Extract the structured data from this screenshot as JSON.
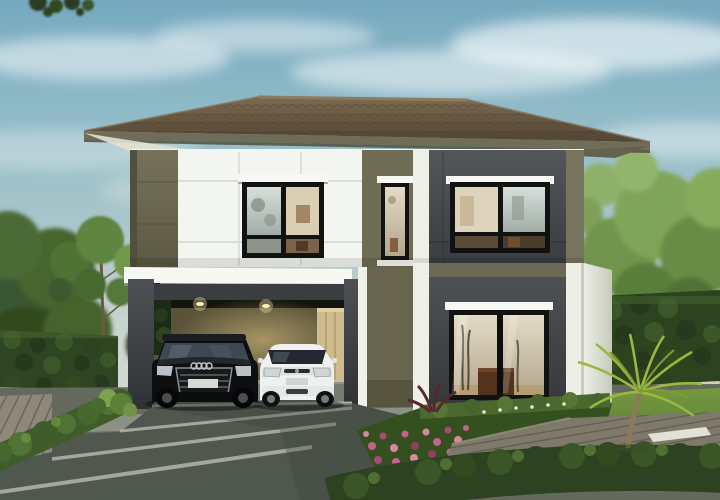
{
  "scene": {
    "type": "architectural-rendering",
    "description": "Daytime exterior rendering of a modern two-storey detached house with hipped brown tile roof, olive and white panelled upper facade, charcoal lower wing, an open carport containing a black SUV and a white hatchback, paver driveway, timber decks, trimmed hedges, pink flower beds, palms and background trees under a hazy blue sky",
    "house": {
      "storeys": 2,
      "roof": "hipped brown tile",
      "carport": {
        "cars": [
          "black-suv",
          "white-hatchback"
        ],
        "ceiling_lights": 2,
        "rear_door": "light wood"
      },
      "windows": [
        "upper-left-black-frame",
        "upper-narrow-black-frame",
        "upper-right-black-frame",
        "lower-right-sliding-glass"
      ]
    },
    "landscape": [
      "left-hedge-wall",
      "white-flower-strip",
      "left-timber-deck",
      "low-diagonal-hedge",
      "paver-driveway",
      "pink-flower-bed",
      "front-trimmed-hedge",
      "right-timber-deck-path",
      "palm-plant",
      "right-lawn",
      "stepping-stones",
      "right-hedge-wall",
      "background-trees"
    ]
  },
  "palette": {
    "sky_top": "#76a9bf",
    "sky_mid": "#a9c6cb",
    "sky_horizon": "#d6dbd1",
    "cloud": "#ffffff",
    "roof_light": "#7d6b52",
    "roof_dark": "#514435",
    "fascia": "#6f6d55",
    "soffit": "#e2e0d2",
    "wall_olive": "#6d6b54",
    "wall_olive_dark": "#5b5944",
    "wall_white": "#f3f5f0",
    "panel_line": "#d2d6cc",
    "wall_charcoal": "#4b4f52",
    "wall_charcoal_dark": "#35393b",
    "band_white": "#f7f8f3",
    "carport_back": "#5a5339",
    "carport_glow": "#a8955f",
    "door_wood": "#cfbb8d",
    "frame_black": "#121212",
    "glass_warm": "#d8cdb2",
    "glass_cool": "#c6d0ca",
    "hedge_dark": "#2e4521",
    "hedge_mid": "#47642e",
    "leaf_light": "#7fa04f",
    "grass_light": "#71963f",
    "grass_dark": "#50772f",
    "deck_left": "#8d887a",
    "deck_right": "#7f796b",
    "drive": "#4f574e",
    "drive_strip": "#b9bdb2",
    "flower_pink": "#c4638b",
    "flower_white": "#dfe2cc",
    "palm": "#9ab83f",
    "car_black": "#0c0e10",
    "car_white": "#eef1f0",
    "trunk": "#6b5a42",
    "concrete": "#8e948a"
  }
}
